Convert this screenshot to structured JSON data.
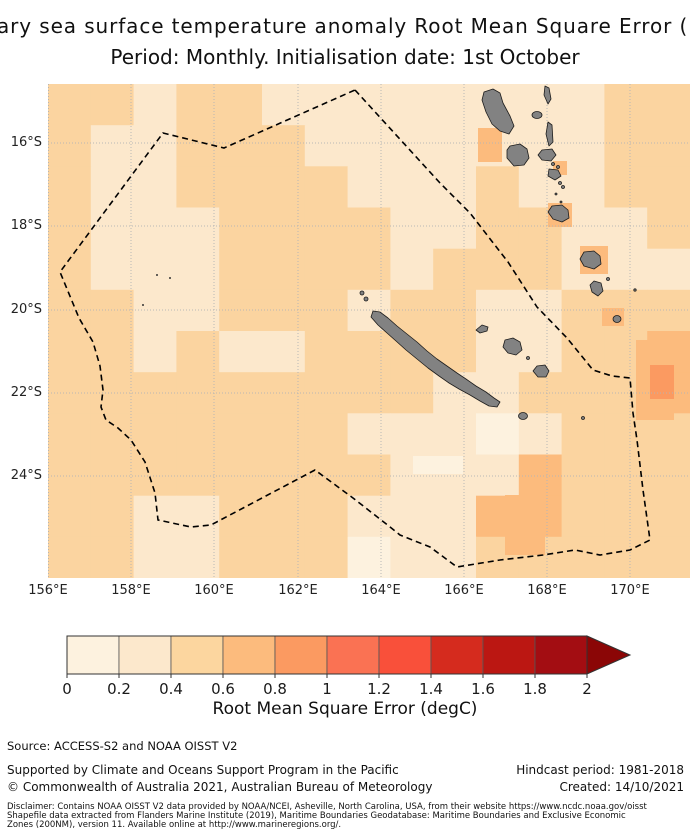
{
  "title": {
    "line1_visible": "ary sea surface temperature anomaly Root Mean Square Error (RM",
    "line2": "Period: Monthly. Initialisation date: 1st October"
  },
  "map": {
    "lat_labels": [
      "16°S",
      "18°S",
      "20°S",
      "22°S",
      "24°S"
    ],
    "lon_labels": [
      "156°E",
      "158°E",
      "160°E",
      "162°E",
      "164°E",
      "166°E",
      "168°E",
      "170°E"
    ],
    "band_colors": {
      "1": "#fdf2df",
      "2": "#fce8cc",
      "3": "#fbd4a0",
      "4": "#fcbb7d",
      "5": "#fb9a61"
    },
    "island_color": "#828282",
    "island_outline": "#1c1c1c",
    "eez_color": "#000000",
    "gridline_color": "#b5b5b5"
  },
  "chart_data": {
    "type": "heatmap",
    "title": "Sea surface temperature anomaly Root Mean Square Error (RMSE)",
    "subtitle": "Period: Monthly. Initialisation date: 1st October",
    "region": "New Caledonia EEZ (dashed boundary), Vanuatu and Loyalty Islands shown in grey",
    "lon_ticks": [
      "156°E",
      "158°E",
      "160°E",
      "162°E",
      "164°E",
      "166°E",
      "168°E",
      "170°E"
    ],
    "lat_ticks": [
      "16°S",
      "18°S",
      "20°S",
      "22°S",
      "24°S"
    ],
    "lon_range_degE": [
      156,
      171.2
    ],
    "lat_range_degS": [
      14.6,
      26.4
    ],
    "value_bands_degC": {
      "1": [
        0.0,
        0.2
      ],
      "2": [
        0.2,
        0.4
      ],
      "3": [
        0.4,
        0.6
      ],
      "4": [
        0.6,
        0.8
      ],
      "5": [
        0.8,
        1.0
      ]
    },
    "grid_note": "RMSE field, 15x12 coarse cells, band index per cell (most of domain 0.2-0.6 degC)",
    "grid_rows": [
      "332332222222233",
      "322333222222233",
      "322333322232233",
      "322233332233223",
      "322233332333222",
      "332233323322333",
      "332322333322334",
      "333333333223334",
      "333333322212333",
      "333333332224333",
      "332233322244333",
      "332233312233333"
    ],
    "patches": [
      {
        "x": 457,
        "y": 411,
        "w": 40,
        "h": 60,
        "band": "4"
      },
      {
        "x": 588,
        "y": 256,
        "w": 38,
        "h": 80,
        "band": "4"
      },
      {
        "x": 602,
        "y": 281,
        "w": 24,
        "h": 34,
        "band": "5"
      },
      {
        "x": 430,
        "y": 44,
        "w": 24,
        "h": 34,
        "band": "4"
      },
      {
        "x": 505,
        "y": 77,
        "w": 14,
        "h": 14,
        "band": "4"
      },
      {
        "x": 500,
        "y": 119,
        "w": 24,
        "h": 24,
        "band": "4"
      },
      {
        "x": 532,
        "y": 162,
        "w": 28,
        "h": 28,
        "band": "4"
      },
      {
        "x": 554,
        "y": 224,
        "w": 22,
        "h": 18,
        "band": "4"
      },
      {
        "x": 365,
        "y": 372,
        "w": 50,
        "h": 18,
        "band": "1"
      }
    ]
  },
  "colorbar": {
    "tick_labels": [
      "0",
      "0.2",
      "0.4",
      "0.6",
      "0.8",
      "1",
      "1.2",
      "1.4",
      "1.6",
      "1.8",
      "2"
    ],
    "segment_colors": [
      "#fdf2df",
      "#fce8cc",
      "#fcd69f",
      "#fcbb7d",
      "#fb9a61",
      "#fa7253",
      "#f9503a",
      "#d52b1e",
      "#bb1712",
      "#a30d12"
    ],
    "arrow_color": "#8b0606",
    "label": "Root Mean Square Error (degC)"
  },
  "footer": {
    "source": "Source: ACCESS-S2 and NOAA OISST V2",
    "supported": "Supported by Climate and Oceans Support Program in the Pacific",
    "copyright": "© Commonwealth of Australia 2021, Australian Bureau of Meteorology",
    "hindcast": "Hindcast period: 1981-2018",
    "created": "Created: 14/10/2021",
    "disclaimer_line1": "Disclaimer: Contains NOAA OISST V2 data provided by NOAA/NCEI, Asheville, North Carolina, USA, from their website https://www.ncdc.noaa.gov/oisst",
    "disclaimer_line2": "Shapefile data extracted from Flanders Marine Institute (2019), Maritime Boundaries Geodatabase: Maritime Boundaries and Exclusive Economic",
    "disclaimer_line3": "Zones (200NM), version 11. Available online at http://www.marineregions.org/."
  }
}
